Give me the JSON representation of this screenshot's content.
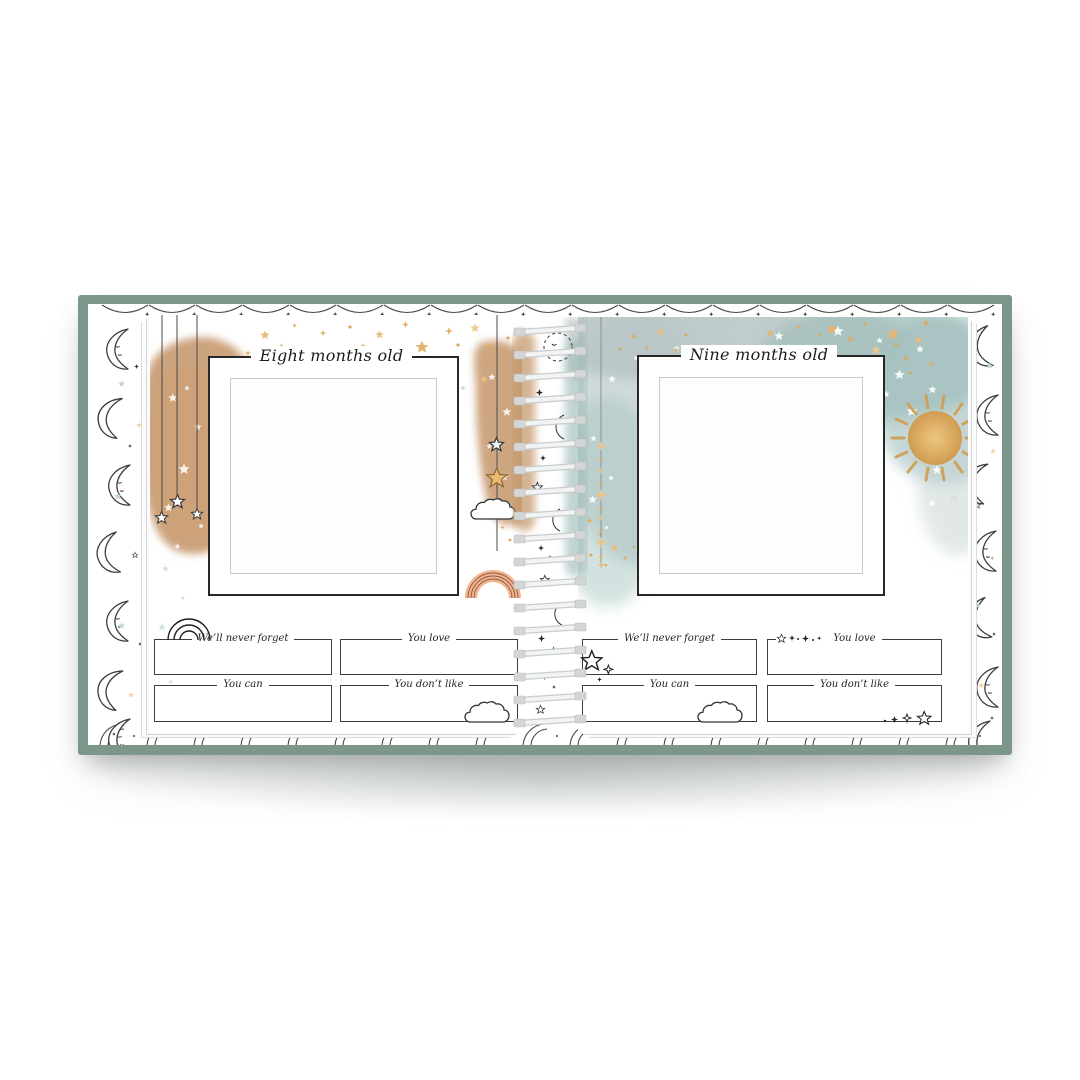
{
  "book": {
    "cover_color": "#7d968a",
    "binding_style": "spiral-coil",
    "border_pattern_icons": [
      "crescent-moon-face-icon",
      "crescent-moon-icon",
      "star-icon",
      "sparkle-icon"
    ],
    "colors": {
      "cover_sage": "#7d968a",
      "watercolor_tan": "#c6996e",
      "watercolor_teal": "#9fbcba",
      "gold_star": "#e3b26e",
      "rainbow_peach": "#f4b38d",
      "ink": "#2f2f2f",
      "page": "#ffffff"
    },
    "left_page": {
      "title": "Eight months old",
      "fields": [
        {
          "label": "We’ll never forget"
        },
        {
          "label": "You love"
        },
        {
          "label": "You can"
        },
        {
          "label": "You don’t like"
        }
      ],
      "decoration_icons": [
        "tan-watercolor-blob",
        "gold-star-scatter",
        "hanging-star-strings",
        "star-cloud-rainbow-mobile",
        "rainbow-doodle-icon",
        "cloud-doodle-icon"
      ]
    },
    "right_page": {
      "title": "Nine months old",
      "fields": [
        {
          "label": "We’ll never forget"
        },
        {
          "label": "You love"
        },
        {
          "label": "You can"
        },
        {
          "label": "You don’t like"
        }
      ],
      "decoration_icons": [
        "teal-watercolor-sky",
        "gold-star-scatter",
        "white-star-scatter",
        "sun-icon",
        "hanging-star-garland",
        "star-doodle-icons",
        "cloud-doodle-icon",
        "sparkle-doodle-icons"
      ]
    }
  }
}
